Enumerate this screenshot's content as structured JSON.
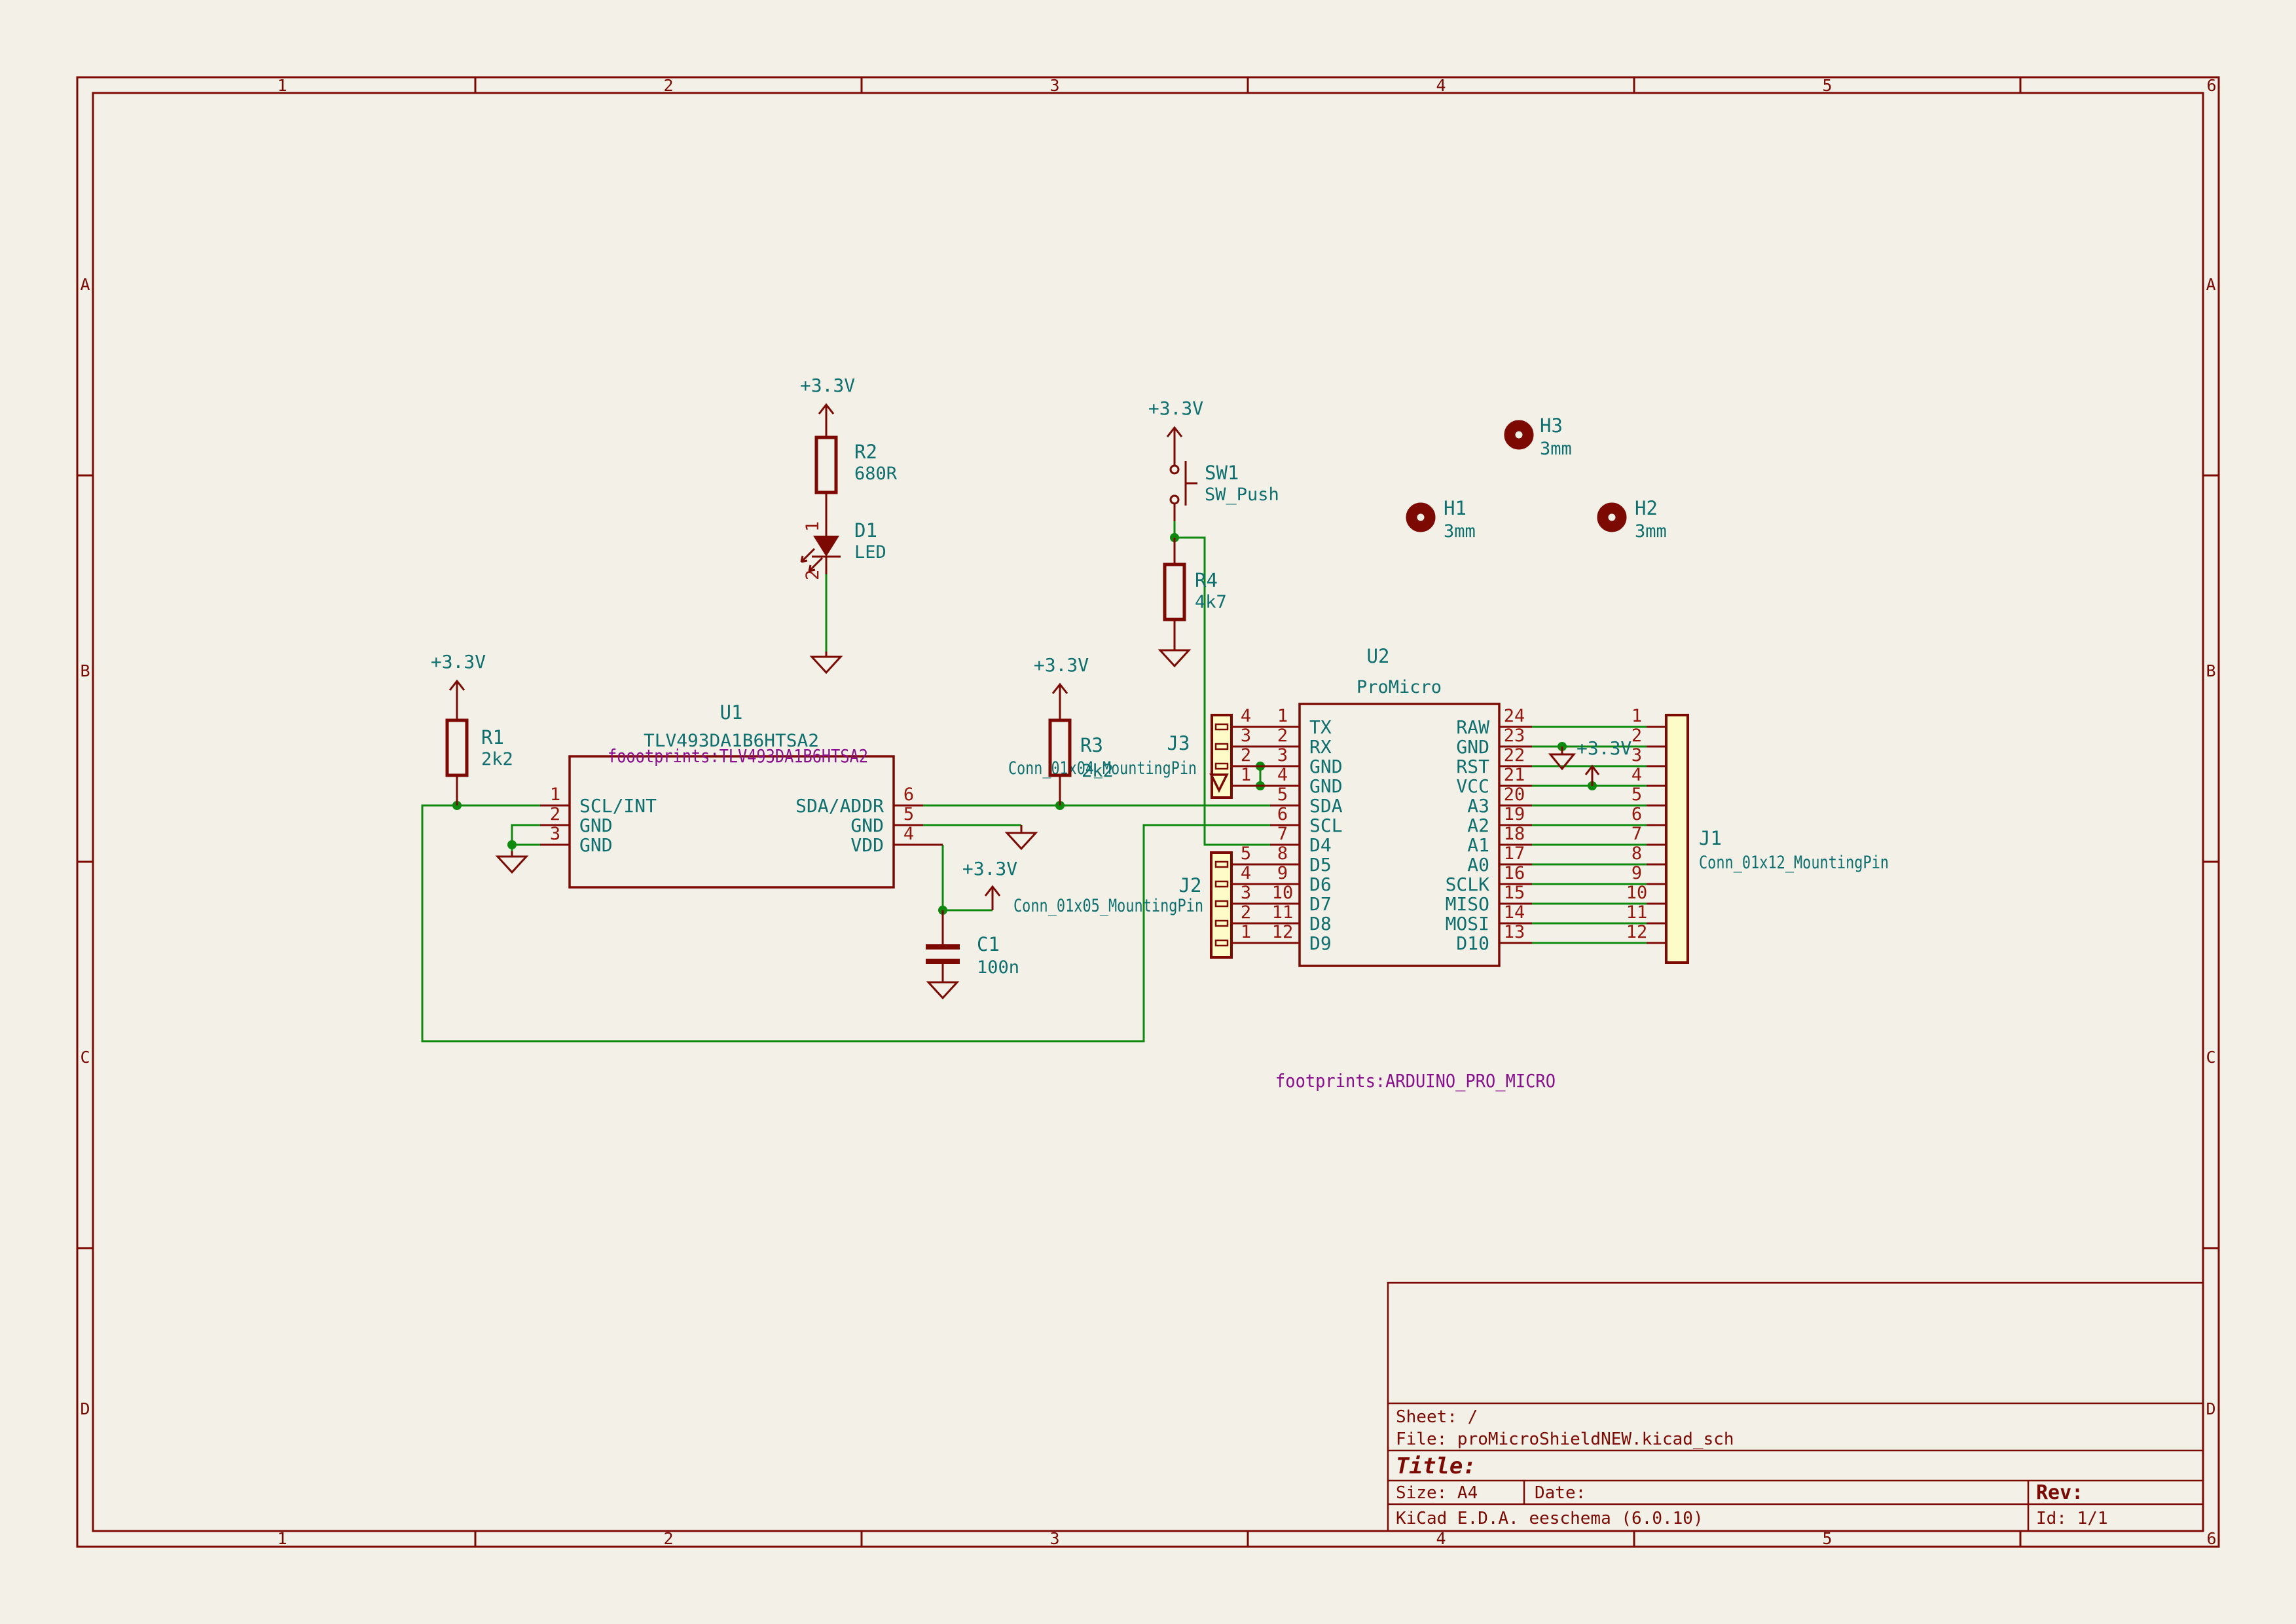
{
  "border": {
    "columns": [
      "1",
      "2",
      "3",
      "4",
      "5",
      "6"
    ],
    "rows": [
      "A",
      "B",
      "C",
      "D"
    ]
  },
  "title_block": {
    "sheet": "Sheet: /",
    "file": "File: proMicroShieldNEW.kicad_sch",
    "title": "Title:",
    "size": "Size: A4",
    "date": "Date:",
    "rev": "Rev:",
    "generator": "KiCad E.D.A.  eeschema (6.0.10)",
    "id": "Id: 1/1"
  },
  "power": {
    "v33": "+3.3V"
  },
  "u1": {
    "ref": "U1",
    "value": "TLV493DA1B6HTSA2",
    "footprint": "foootprints:TLV493DA1B6HTSA2",
    "pins_left": [
      {
        "num": "1",
        "name": "SCL/INT"
      },
      {
        "num": "2",
        "name": "GND"
      },
      {
        "num": "3",
        "name": "GND"
      }
    ],
    "pins_right": [
      {
        "num": "6",
        "name": "SDA/ADDR"
      },
      {
        "num": "5",
        "name": "GND"
      },
      {
        "num": "4",
        "name": "VDD"
      }
    ]
  },
  "u2": {
    "ref": "U2",
    "value": "ProMicro",
    "footprint": "footprints:ARDUINO_PRO_MICRO",
    "left": [
      {
        "j": "4",
        "u": "1",
        "name": "TX"
      },
      {
        "j": "3",
        "u": "2",
        "name": "RX"
      },
      {
        "j": "2",
        "u": "3",
        "name": "GND"
      },
      {
        "j": "1",
        "u": "4",
        "name": "GND"
      },
      {
        "j": "",
        "u": "5",
        "name": "SDA"
      },
      {
        "j": "",
        "u": "6",
        "name": "SCL"
      },
      {
        "j": "",
        "u": "7",
        "name": "D4"
      },
      {
        "j": "5",
        "u": "8",
        "name": "D5"
      },
      {
        "j": "4",
        "u": "9",
        "name": "D6"
      },
      {
        "j": "3",
        "u": "10",
        "name": "D7"
      },
      {
        "j": "2",
        "u": "11",
        "name": "D8"
      },
      {
        "j": "1",
        "u": "12",
        "name": "D9"
      }
    ],
    "right": [
      {
        "u": "24",
        "j": "1",
        "name": "RAW"
      },
      {
        "u": "23",
        "j": "2",
        "name": "GND"
      },
      {
        "u": "22",
        "j": "3",
        "name": "RST"
      },
      {
        "u": "21",
        "j": "4",
        "name": "VCC"
      },
      {
        "u": "20",
        "j": "5",
        "name": "A3"
      },
      {
        "u": "19",
        "j": "6",
        "name": "A2"
      },
      {
        "u": "18",
        "j": "7",
        "name": "A1"
      },
      {
        "u": "17",
        "j": "8",
        "name": "A0"
      },
      {
        "u": "16",
        "j": "9",
        "name": "SCLK"
      },
      {
        "u": "15",
        "j": "10",
        "name": "MISO"
      },
      {
        "u": "14",
        "j": "11",
        "name": "MOSI"
      },
      {
        "u": "13",
        "j": "12",
        "name": "D10"
      }
    ]
  },
  "j1": {
    "ref": "J1",
    "value": "Conn_01x12_MountingPin"
  },
  "j2": {
    "ref": "J2",
    "value": "Conn_01x05_MountingPin"
  },
  "j3": {
    "ref": "J3",
    "value": "Conn_01x04_MountingPin"
  },
  "r1": {
    "ref": "R1",
    "value": "2k2"
  },
  "r2": {
    "ref": "R2",
    "value": "680R"
  },
  "r3": {
    "ref": "R3",
    "value": "2k2"
  },
  "r4": {
    "ref": "R4",
    "value": "4k7"
  },
  "c1": {
    "ref": "C1",
    "value": "100n"
  },
  "d1": {
    "ref": "D1",
    "value": "LED",
    "pin1": "1",
    "pin2": "2"
  },
  "sw1": {
    "ref": "SW1",
    "value": "SW_Push"
  },
  "h1": {
    "ref": "H1",
    "value": "3mm"
  },
  "h2": {
    "ref": "H2",
    "value": "3mm"
  },
  "h3": {
    "ref": "H3",
    "value": "3mm"
  }
}
